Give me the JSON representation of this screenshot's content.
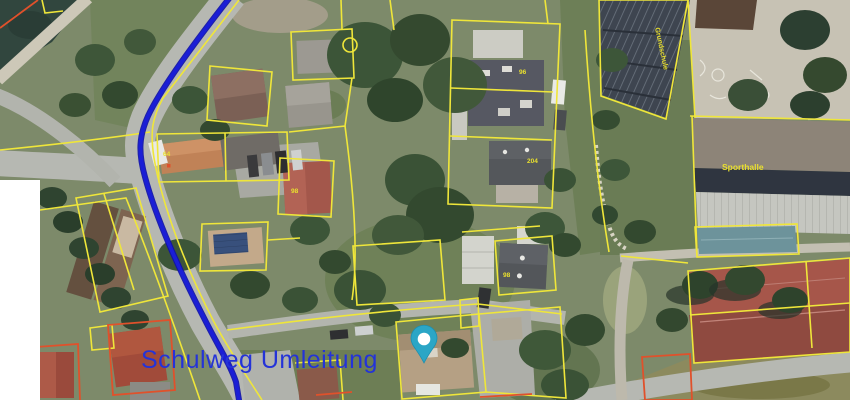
{
  "map": {
    "view": "satellite-aerial",
    "route_label": {
      "text": "Schulweg Umleitung"
    },
    "place_labels": {
      "sporthalle": "Sporthalle",
      "school_building": "Grundschule"
    },
    "parcel_numbers": [
      {
        "value": "64"
      },
      {
        "value": "96"
      },
      {
        "value": "204"
      },
      {
        "value": "98"
      },
      {
        "value": "98"
      }
    ],
    "marker": {
      "name": "location-pin"
    },
    "colors": {
      "route_blue": "#1a1ed6",
      "route_casing": "#0d10a8",
      "label_blue": "#2433d8",
      "parcel_yellow": "#efe63a",
      "outline_red": "#e0512b",
      "marker_teal": "#2ba6c6",
      "water": "#31463e",
      "road": "#b6b8b2",
      "court_red": "#a6564a"
    }
  }
}
